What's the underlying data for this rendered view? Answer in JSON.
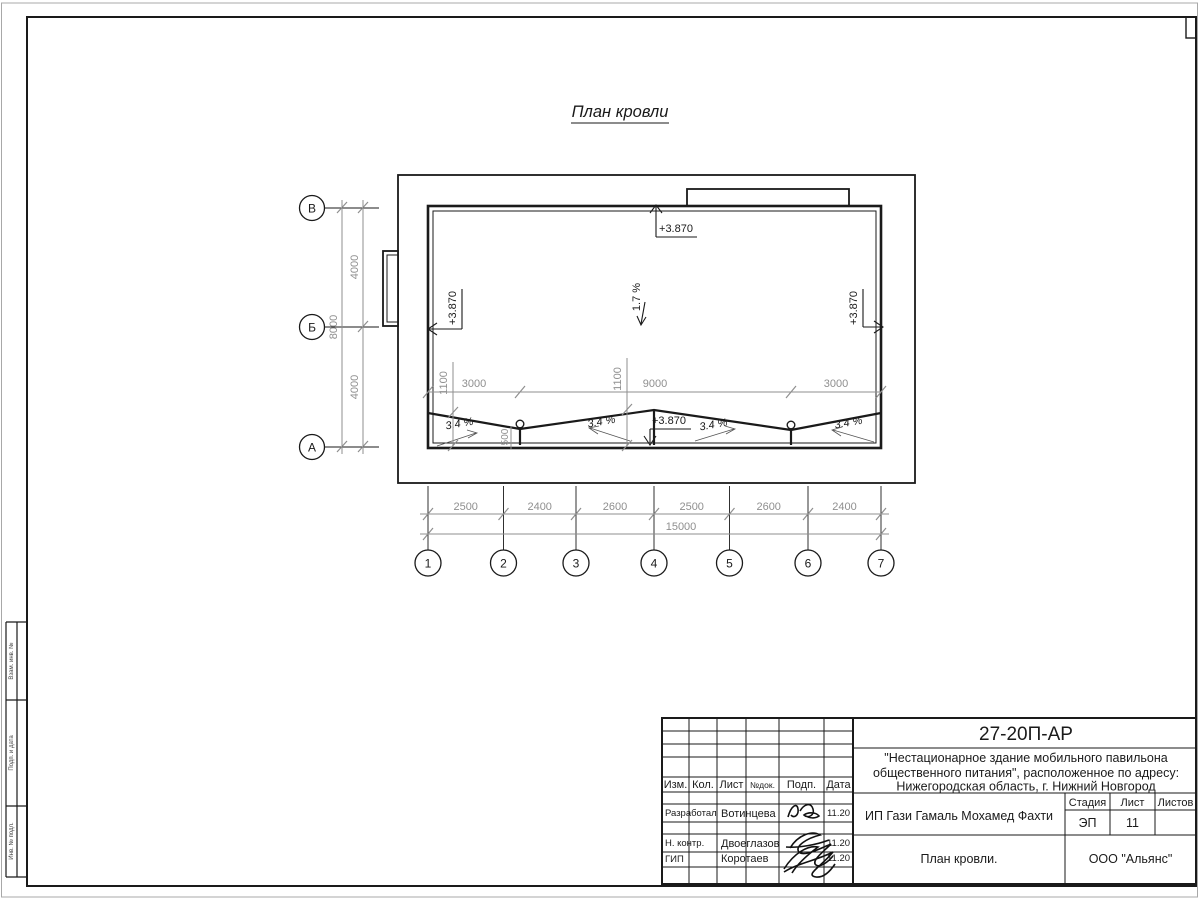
{
  "page": {
    "drawing_title": "План кровли"
  },
  "plan": {
    "elevation_top": "+3.870",
    "elevation_left": "+3.870",
    "elevation_right": "+3.870",
    "elevation_ridge": "+3.870",
    "slope_main": "1.7 %",
    "slope_roof": "3.4 %"
  },
  "dims": {
    "roof": [
      "3000",
      "9000",
      "3000"
    ],
    "valley_offset": "1100",
    "drain": "500",
    "left_total": "8000",
    "left_seg": "4000",
    "bottom": [
      "2500",
      "2400",
      "2600",
      "2500",
      "2600",
      "2400"
    ],
    "bottom_total": "15000"
  },
  "axes": {
    "letters": [
      "В",
      "Б",
      "А"
    ],
    "numbers": [
      "1",
      "2",
      "3",
      "4",
      "5",
      "6",
      "7"
    ]
  },
  "side_stamp": {
    "rows": [
      "Взам. инв. №",
      "Подп. и дата",
      "Инв. № подл."
    ]
  },
  "title_block": {
    "doc_number": "27-20П-АР",
    "project_line1": "\"Нестационарное здание мобильного павильона",
    "project_line2": "общественного питания\", расположенное по адресу:",
    "project_line3": "Нижегородская область, г. Нижний Новгород",
    "client": "ИП Гази Гамаль Мохамед Фахти",
    "sheet_title": "План кровли.",
    "company": "ООО \"Альянс\"",
    "headers": {
      "izm": "Изм.",
      "kol": "Кол.",
      "list": "Лист",
      "ndok": "№док.",
      "podp": "Подп.",
      "data": "Дата"
    },
    "stage_label": "Стадия",
    "sheet_label": "Лист",
    "sheets_label": "Листов",
    "stage": "ЭП",
    "sheet_number": "11",
    "roles": [
      {
        "role": "Разработал",
        "name": "Вотинцева",
        "date": "11.20"
      },
      {
        "role": "Н. контр.",
        "name": "Двоеглазов",
        "date": "11.20"
      },
      {
        "role": "ГИП",
        "name": "Коротаев",
        "date": "11.20"
      }
    ]
  }
}
